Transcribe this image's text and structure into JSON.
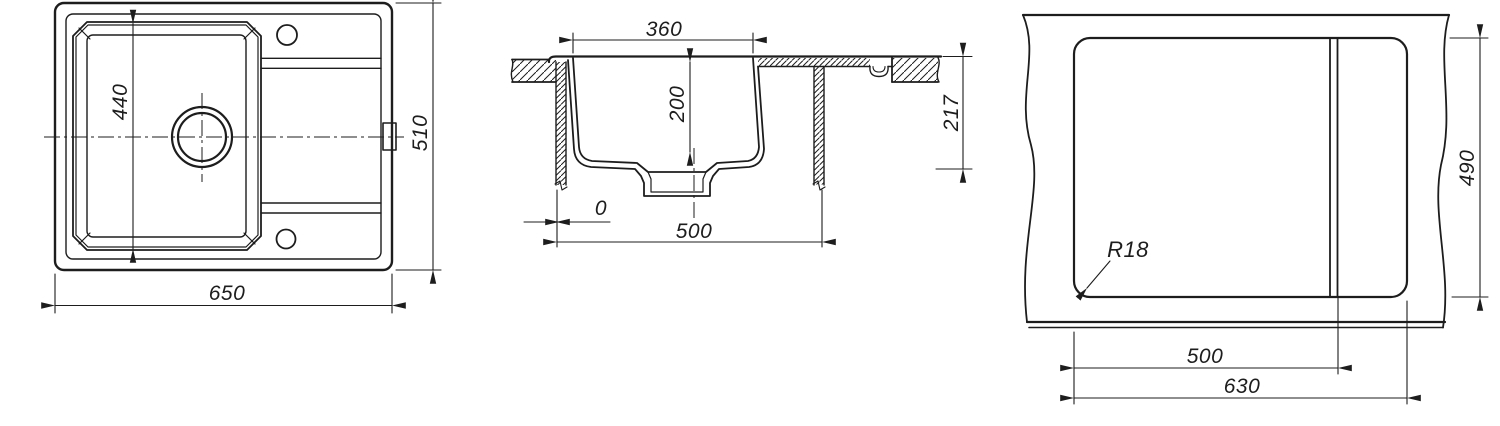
{
  "drawing_labels": {
    "plan": {
      "bowl_height": "440",
      "overall_width": "650",
      "overall_depth": "510"
    },
    "section": {
      "bowl_top_width": "360",
      "bowl_depth": "200",
      "total_height": "217",
      "edge_offset": "0",
      "mount_span": "500"
    },
    "cutout": {
      "corner_radius": "R18",
      "cut_height": "490",
      "cut_width": "500",
      "overall_width": "630"
    }
  },
  "colors": {
    "line": "#1d1d1d",
    "background": "#ffffff"
  }
}
